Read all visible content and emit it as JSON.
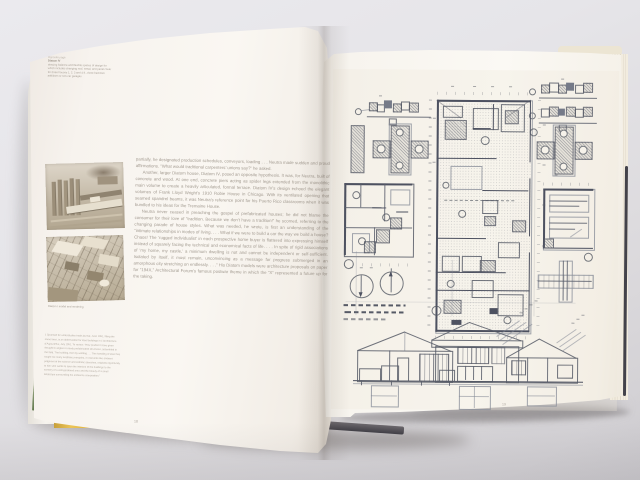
{
  "photo_scene": {
    "description": "Photograph of an open architecture monograph lying on a pale grey surface; left page with body text, a margin caption and two sepia model photographs; right page is a full-page reproduction of Diatom house working drawings (plans, pier details, north arrows, scale bars and three hip-roofed sections).",
    "background_color": "#e6e5e9",
    "page_color": "#faf7f2",
    "ink_color": "#4d5160",
    "jacket_yellow": "#e5ba48",
    "jacket_green": "#6f8355",
    "cover_edge_dark": "#43424a"
  },
  "left_page": {
    "page_number": "18",
    "margin_caption": {
      "lines": [
        "Opposite page",
        "Diatom IV",
        "drawing balance and flexible spaces of design for",
        "which includes changing roof, metal, and panel cover",
        "for three houses 1, 2, 3 and 4 ft., three bedroom",
        "additions or two-car garages"
      ]
    },
    "photo_caption": "Diatom I model and rendering",
    "body_paragraphs": [
      "partially, he designated production schedules, conveyors, loading . . . Neutra made sudden and proud affirmations. “What would traditional carpenters’ unions say?” he asked.",
      "Another, larger Diatom house, Diatom IV, posed an opposite hypothesis. It was, for Neutra, built of concrete and wood. At one end, concrete piers acting as spider legs extended from the monolithic main volume to create a heavily articulated, formal terrace. Diatom IV’s design echoed the elegant volumes of Frank Lloyd Wright’s 1910 Robie House in Chicago. With its ventilated opening that seamed spandrel beams, it was Neutra’s reference point for his Puerto Rico classrooms when it was bundled to his ideas for the Tremaine House.",
      "Neutra never ceased in preaching the gospel of prefabricated houses; he did not blame the consumer for their love of “tradition. Because we don’t have a tradition!” he scorned, referring to the changing parade of house styles. What was needed, he wrote, is first an understanding of the “intimate relationships in modes of living. . . . What if we were to build a car the way we build a house? Chaos! The ‘rugged individualist’ in each prospective home buyer is flattered into expressing himself instead of squarely facing the technical and economical facts of life. . . . In spite of rigid associations of ‘my home, my castle,’ a minimum dwelling is not and cannot be independent or self-sufficient. Isolated by itself, it must remain, unconvincing as a message for progress submerged in an amorphous city stretching on endlessly. . . .” His Diatom models were architecture proposals on paper for “194X,” Architectural Forum’s famous postwar theme in which the “X” represented a future up for the taking."
    ],
    "footnote": "1  Spanned for understudies trade journal, June 1951, filling the same lines, is an abbreviation for steel buildings in L’Architecture d’Aujourd’hui, July 1951. To review: “How prudent I have given thought to angles or newly prefabricated structures, assembled in the field. The building, then by welding . . . This handling of steel has taught me many aesthetic principles, in moments like ambient judgment of the science and esthetic speeches, originals opportunity to him who wants to open the interiors of the buildings to the scenery of a well-gardened area and the beauty of a small landscape surrounding his ambience composition.”"
  },
  "right_page": {
    "page_number": "19",
    "drawing_elements": [
      "module-strip-detail",
      "pier-cross-detail",
      "main-floor-plan",
      "square-floor-plan",
      "framing-plan",
      "framing-cross-detail",
      "north-arrows",
      "graphic-scale-bars",
      "three-house-sections"
    ]
  }
}
